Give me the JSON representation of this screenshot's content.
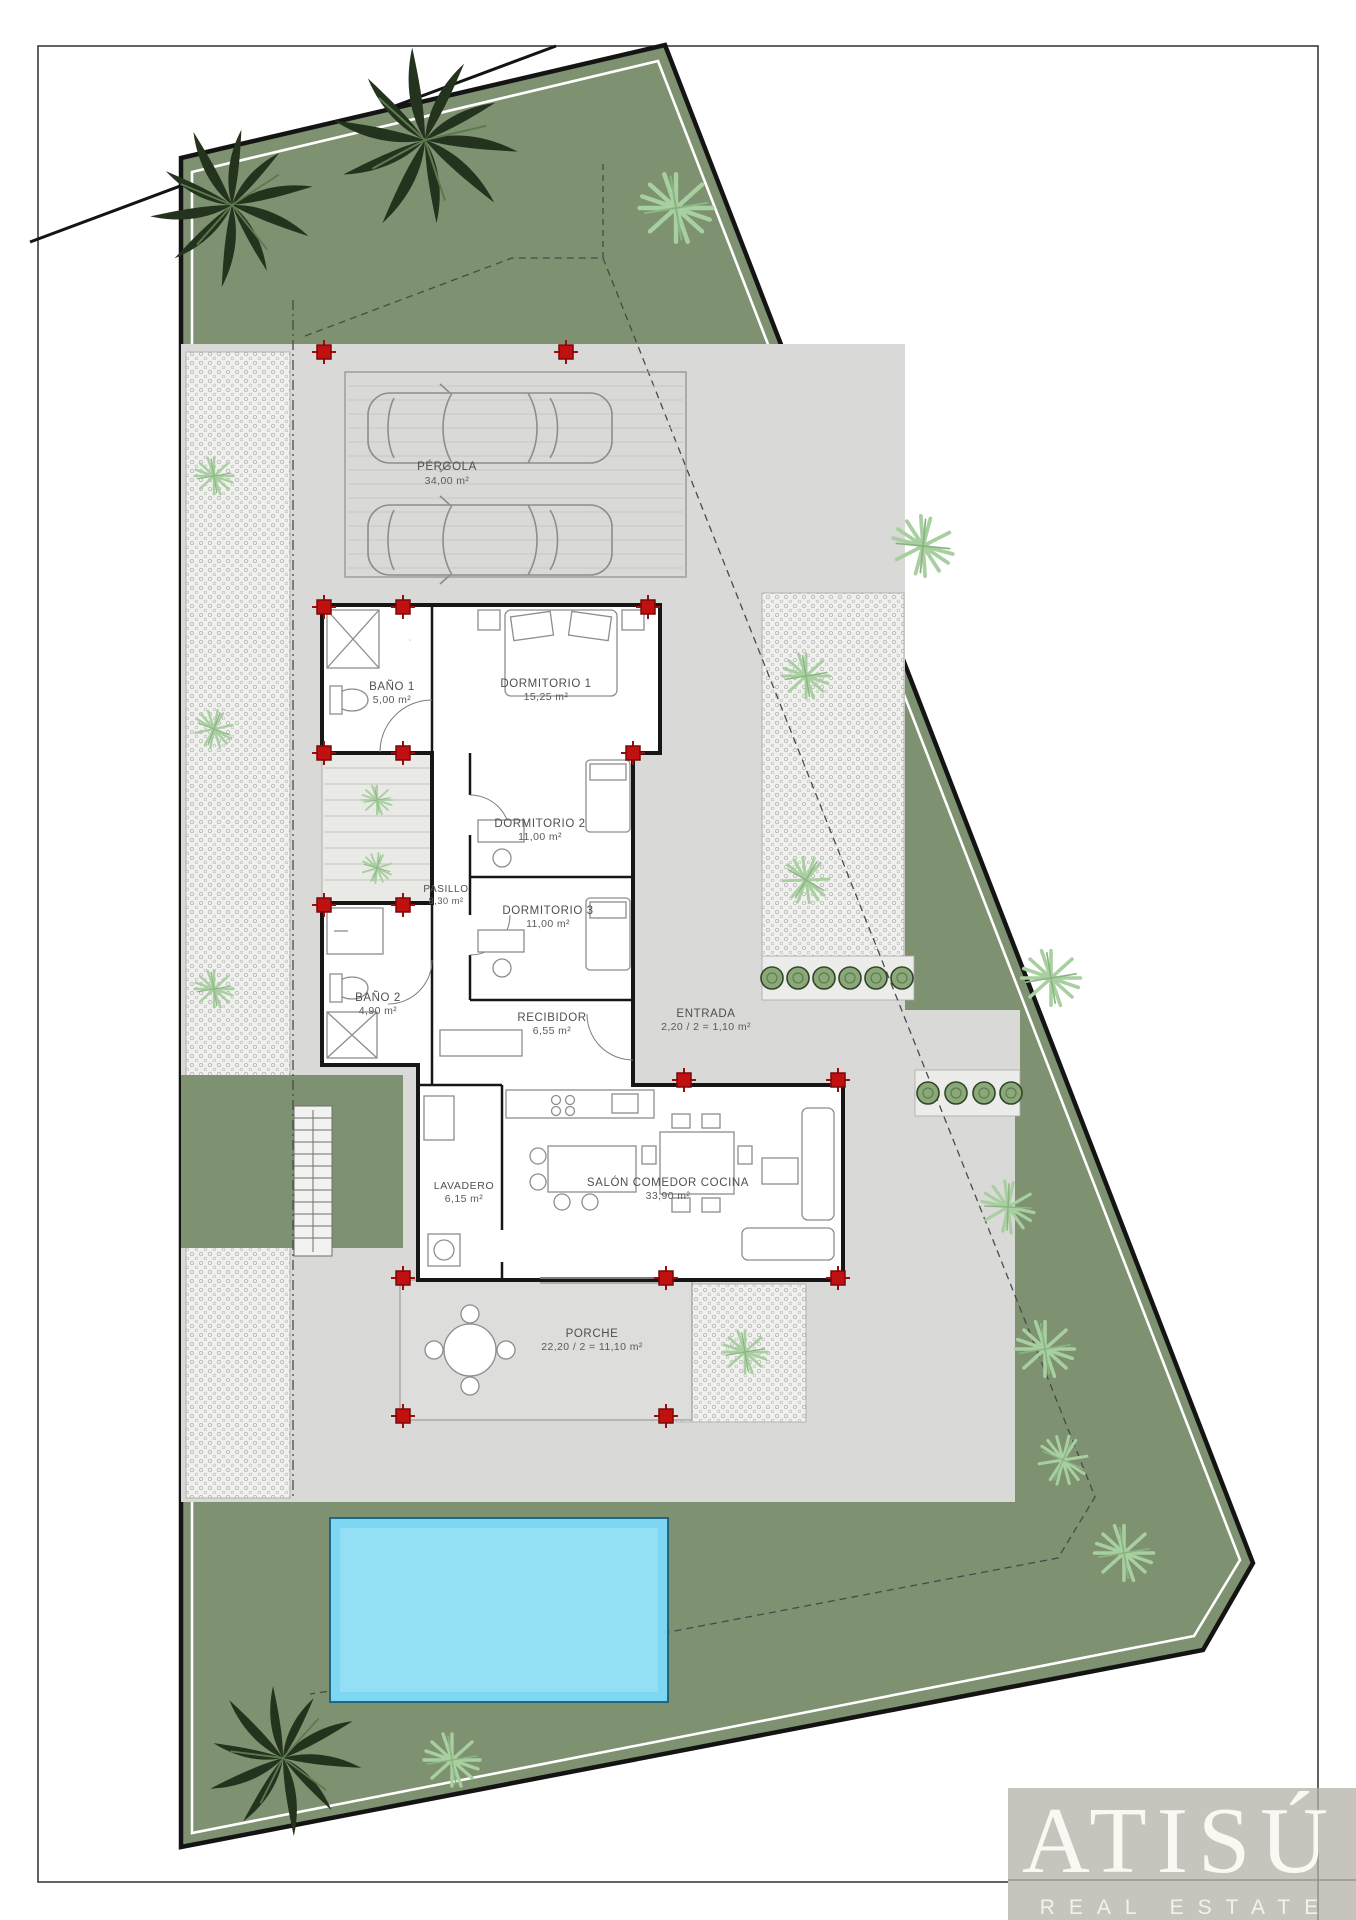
{
  "branding": {
    "name": "ATISÚ",
    "tagline": "REAL ESTATE"
  },
  "rooms": [
    {
      "id": "pergola",
      "label": "PÉRGOLA",
      "area": "34,00 m²"
    },
    {
      "id": "bano1",
      "label": "BAÑO 1",
      "area": "5,00 m²"
    },
    {
      "id": "dormitorio1",
      "label": "DORMITORIO 1",
      "area": "15,25 m²"
    },
    {
      "id": "dormitorio2",
      "label": "DORMITORIO 2",
      "area": "11,00 m²"
    },
    {
      "id": "pasillo",
      "label": "PASILLO",
      "area": "8,30 m²"
    },
    {
      "id": "dormitorio3",
      "label": "DORMITORIO 3",
      "area": "11,00 m²"
    },
    {
      "id": "bano2",
      "label": "BAÑO 2",
      "area": "4,90 m²"
    },
    {
      "id": "recibidor",
      "label": "RECIBIDOR",
      "area": "6,55 m²"
    },
    {
      "id": "entrada",
      "label": "ENTRADA",
      "area": "2,20 / 2 = 1,10 m²"
    },
    {
      "id": "lavadero",
      "label": "LAVADERO",
      "area": "6,15 m²"
    },
    {
      "id": "salon",
      "label": "SALÓN COMEDOR COCINA",
      "area": "33,90 m²"
    },
    {
      "id": "porche",
      "label": "PORCHE",
      "area": "22,20 / 2 = 11,10 m²"
    }
  ],
  "colors": {
    "garden_green": "#7e9170",
    "paving_gray": "#d9d9d7",
    "pool_blue": "#7ed7f2",
    "column_red": "#c01010",
    "logo_background": "#c7c3bd",
    "light_plant_green": "#a8cfa0",
    "wall_black": "#161616"
  }
}
